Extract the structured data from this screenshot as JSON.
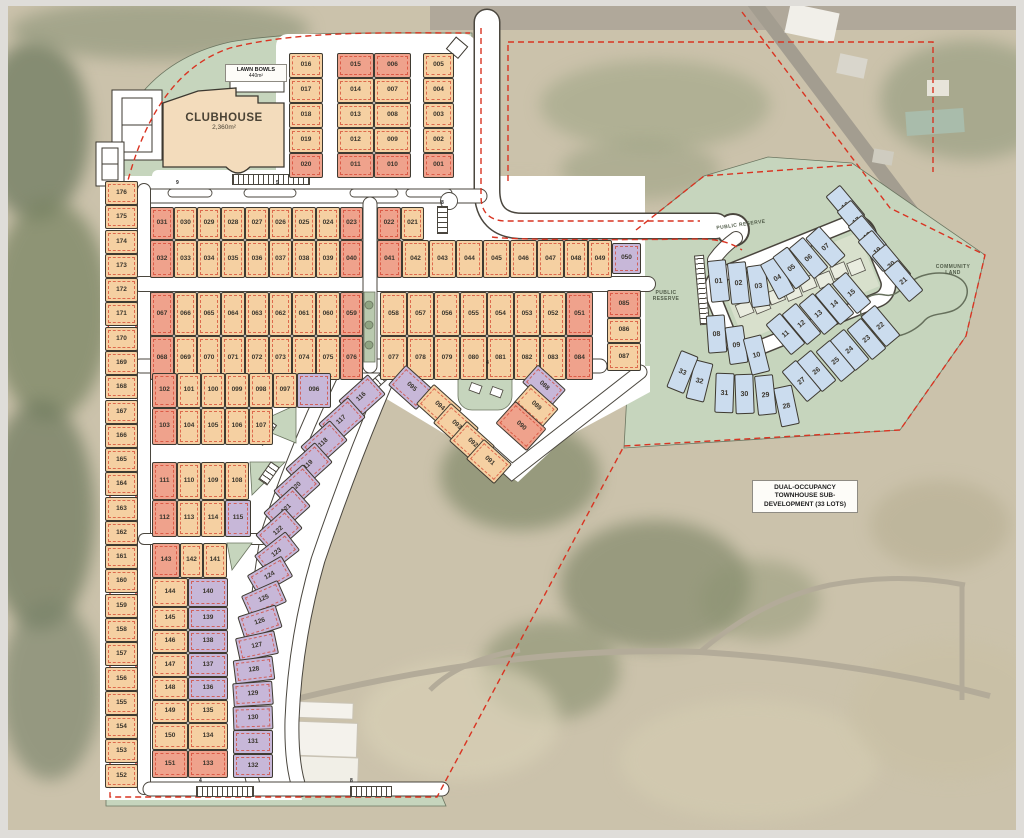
{
  "labels": {
    "clubhouse_title": "CLUBHOUSE",
    "clubhouse_area": "2,360m²",
    "lawn_bowls_title": "LAWN BOWLS",
    "lawn_bowls_area": "440m²",
    "public_reserve_a": "PUBLIC RESERVE",
    "public_reserve_b": "PUBLIC RESERVE",
    "community_land": "COMMUNITY LAND",
    "townhouse_note_line1": "DUAL-OCCUPANCY",
    "townhouse_note_line2": "TOWNHOUSE SUB-",
    "townhouse_note_line3": "DEVELOPMENT (33 LOTS)"
  },
  "palette": {
    "lot_standard": "#f5d0a2",
    "lot_premium": "#efa28c",
    "lot_medium_density": "#c7b7d8",
    "lot_townhouse": "#cbdcee",
    "reserve_green": "#c6d5bd",
    "boundary_red": "#d93422",
    "road_white": "#ffffff"
  },
  "road_markers": [
    {
      "t": "9",
      "x": 176,
      "y": 181
    },
    {
      "t": "5",
      "x": 276,
      "y": 181
    },
    {
      "t": "8",
      "x": 441,
      "y": 201
    },
    {
      "t": "4",
      "x": 199,
      "y": 779
    },
    {
      "t": "8",
      "x": 350,
      "y": 779
    },
    {
      "t": "4",
      "x": 486,
      "y": 361
    }
  ],
  "lots": [
    [
      "176",
      105,
      181,
      33,
      24,
      "p"
    ],
    [
      "175",
      105,
      205,
      33,
      24,
      "p"
    ],
    [
      "174",
      105,
      230,
      33,
      24,
      "p"
    ],
    [
      "173",
      105,
      254,
      33,
      24,
      "p"
    ],
    [
      "172",
      105,
      278,
      33,
      24,
      "p"
    ],
    [
      "171",
      105,
      302,
      33,
      24,
      "p"
    ],
    [
      "170",
      105,
      327,
      33,
      24,
      "p"
    ],
    [
      "169",
      105,
      351,
      33,
      24,
      "p"
    ],
    [
      "168",
      105,
      375,
      33,
      24,
      "p"
    ],
    [
      "167",
      105,
      400,
      33,
      24,
      "p"
    ],
    [
      "166",
      105,
      424,
      33,
      24,
      "p"
    ],
    [
      "165",
      105,
      448,
      33,
      24,
      "p"
    ],
    [
      "164",
      105,
      472,
      33,
      24,
      "p"
    ],
    [
      "163",
      105,
      497,
      33,
      24,
      "p"
    ],
    [
      "162",
      105,
      521,
      33,
      24,
      "p"
    ],
    [
      "161",
      105,
      545,
      33,
      24,
      "p"
    ],
    [
      "160",
      105,
      569,
      33,
      24,
      "p"
    ],
    [
      "159",
      105,
      594,
      33,
      24,
      "p"
    ],
    [
      "158",
      105,
      618,
      33,
      24,
      "p"
    ],
    [
      "157",
      105,
      642,
      33,
      24,
      "p"
    ],
    [
      "156",
      105,
      667,
      33,
      24,
      "p"
    ],
    [
      "155",
      105,
      691,
      33,
      24,
      "p"
    ],
    [
      "154",
      105,
      715,
      33,
      24,
      "p"
    ],
    [
      "153",
      105,
      739,
      33,
      24,
      "p"
    ],
    [
      "152",
      105,
      764,
      33,
      24,
      "p"
    ],
    [
      "016",
      289,
      53,
      34,
      25,
      "p"
    ],
    [
      "017",
      289,
      78,
      34,
      25,
      "p"
    ],
    [
      "018",
      289,
      103,
      34,
      25,
      "p"
    ],
    [
      "019",
      289,
      128,
      34,
      25,
      "p"
    ],
    [
      "020",
      289,
      153,
      34,
      25,
      "r"
    ],
    [
      "015",
      337,
      53,
      37,
      25,
      "r"
    ],
    [
      "014",
      337,
      78,
      37,
      25,
      "p"
    ],
    [
      "013",
      337,
      103,
      37,
      25,
      "p"
    ],
    [
      "012",
      337,
      128,
      37,
      25,
      "p"
    ],
    [
      "011",
      337,
      153,
      37,
      25,
      "r"
    ],
    [
      "006",
      374,
      53,
      37,
      25,
      "r"
    ],
    [
      "007",
      374,
      78,
      37,
      25,
      "p"
    ],
    [
      "008",
      374,
      103,
      37,
      25,
      "p"
    ],
    [
      "009",
      374,
      128,
      37,
      25,
      "p"
    ],
    [
      "010",
      374,
      153,
      37,
      25,
      "r"
    ],
    [
      "005",
      423,
      53,
      31,
      25,
      "p"
    ],
    [
      "004",
      423,
      78,
      31,
      25,
      "p"
    ],
    [
      "003",
      423,
      103,
      31,
      25,
      "p"
    ],
    [
      "002",
      423,
      128,
      31,
      25,
      "p"
    ],
    [
      "001",
      423,
      153,
      31,
      25,
      "r"
    ],
    [
      "031",
      150,
      207,
      24,
      33,
      "r"
    ],
    [
      "030",
      174,
      207,
      23,
      33,
      "p"
    ],
    [
      "029",
      197,
      207,
      24,
      33,
      "p"
    ],
    [
      "028",
      221,
      207,
      24,
      33,
      "p"
    ],
    [
      "027",
      245,
      207,
      24,
      33,
      "p"
    ],
    [
      "026",
      269,
      207,
      23,
      33,
      "p"
    ],
    [
      "025",
      292,
      207,
      24,
      33,
      "p"
    ],
    [
      "024",
      316,
      207,
      24,
      33,
      "p"
    ],
    [
      "023",
      340,
      207,
      23,
      33,
      "r"
    ],
    [
      "022",
      377,
      207,
      24,
      33,
      "r"
    ],
    [
      "021",
      401,
      207,
      23,
      33,
      "p"
    ],
    [
      "032",
      150,
      240,
      24,
      38,
      "r"
    ],
    [
      "033",
      174,
      240,
      23,
      38,
      "p"
    ],
    [
      "034",
      197,
      240,
      24,
      38,
      "p"
    ],
    [
      "035",
      221,
      240,
      24,
      38,
      "p"
    ],
    [
      "036",
      245,
      240,
      24,
      38,
      "p"
    ],
    [
      "037",
      269,
      240,
      23,
      38,
      "p"
    ],
    [
      "038",
      292,
      240,
      24,
      38,
      "p"
    ],
    [
      "039",
      316,
      240,
      24,
      38,
      "p"
    ],
    [
      "040",
      340,
      240,
      23,
      38,
      "r"
    ],
    [
      "041",
      377,
      240,
      25,
      38,
      "r"
    ],
    [
      "042",
      402,
      240,
      27,
      38,
      "p"
    ],
    [
      "043",
      429,
      240,
      27,
      38,
      "p"
    ],
    [
      "044",
      456,
      240,
      27,
      38,
      "p"
    ],
    [
      "045",
      483,
      240,
      27,
      38,
      "p"
    ],
    [
      "046",
      510,
      240,
      27,
      38,
      "p"
    ],
    [
      "047",
      537,
      240,
      27,
      38,
      "p"
    ],
    [
      "048",
      564,
      240,
      24,
      38,
      "p"
    ],
    [
      "049",
      588,
      240,
      24,
      38,
      "p"
    ],
    [
      "050",
      612,
      243,
      29,
      31,
      "v"
    ],
    [
      "067",
      150,
      292,
      24,
      44,
      "r"
    ],
    [
      "066",
      174,
      292,
      23,
      44,
      "p"
    ],
    [
      "065",
      197,
      292,
      24,
      44,
      "p"
    ],
    [
      "064",
      221,
      292,
      24,
      44,
      "p"
    ],
    [
      "063",
      245,
      292,
      24,
      44,
      "p"
    ],
    [
      "062",
      269,
      292,
      23,
      44,
      "p"
    ],
    [
      "061",
      292,
      292,
      24,
      44,
      "p"
    ],
    [
      "060",
      316,
      292,
      24,
      44,
      "p"
    ],
    [
      "059",
      340,
      292,
      23,
      44,
      "r"
    ],
    [
      "058",
      380,
      292,
      27,
      44,
      "p"
    ],
    [
      "057",
      407,
      292,
      27,
      44,
      "p"
    ],
    [
      "056",
      434,
      292,
      26,
      44,
      "p"
    ],
    [
      "055",
      460,
      292,
      27,
      44,
      "p"
    ],
    [
      "054",
      487,
      292,
      27,
      44,
      "p"
    ],
    [
      "053",
      514,
      292,
      26,
      44,
      "p"
    ],
    [
      "052",
      540,
      292,
      26,
      44,
      "p"
    ],
    [
      "051",
      566,
      292,
      27,
      44,
      "r"
    ],
    [
      "068",
      150,
      336,
      24,
      44,
      "r"
    ],
    [
      "069",
      174,
      336,
      23,
      44,
      "p"
    ],
    [
      "070",
      197,
      336,
      24,
      44,
      "p"
    ],
    [
      "071",
      221,
      336,
      24,
      44,
      "p"
    ],
    [
      "072",
      245,
      336,
      24,
      44,
      "p"
    ],
    [
      "073",
      269,
      336,
      23,
      44,
      "p"
    ],
    [
      "074",
      292,
      336,
      24,
      44,
      "p"
    ],
    [
      "075",
      316,
      336,
      24,
      44,
      "p"
    ],
    [
      "076",
      340,
      336,
      23,
      44,
      "r"
    ],
    [
      "077",
      380,
      336,
      27,
      44,
      "p"
    ],
    [
      "078",
      407,
      336,
      27,
      44,
      "p"
    ],
    [
      "079",
      434,
      336,
      26,
      44,
      "p"
    ],
    [
      "080",
      460,
      336,
      27,
      44,
      "p"
    ],
    [
      "081",
      487,
      336,
      27,
      44,
      "p"
    ],
    [
      "082",
      514,
      336,
      26,
      44,
      "p"
    ],
    [
      "083",
      540,
      336,
      26,
      44,
      "p"
    ],
    [
      "084",
      566,
      336,
      27,
      44,
      "r"
    ],
    [
      "085",
      607,
      290,
      34,
      28,
      "r"
    ],
    [
      "086",
      607,
      318,
      34,
      25,
      "p"
    ],
    [
      "087",
      607,
      343,
      34,
      28,
      "p"
    ],
    [
      "102",
      152,
      373,
      25,
      35,
      "r"
    ],
    [
      "101",
      177,
      373,
      24,
      35,
      "p"
    ],
    [
      "100",
      201,
      373,
      24,
      35,
      "p"
    ],
    [
      "099",
      225,
      373,
      24,
      35,
      "p"
    ],
    [
      "098",
      249,
      373,
      24,
      35,
      "p"
    ],
    [
      "097",
      273,
      373,
      24,
      35,
      "p"
    ],
    [
      "096",
      297,
      373,
      34,
      35,
      "v"
    ],
    [
      "103",
      152,
      408,
      25,
      37,
      "r"
    ],
    [
      "104",
      177,
      408,
      24,
      37,
      "p"
    ],
    [
      "105",
      201,
      408,
      24,
      37,
      "p"
    ],
    [
      "106",
      225,
      408,
      24,
      37,
      "p"
    ],
    [
      "107",
      249,
      408,
      24,
      37,
      "p"
    ],
    [
      "111",
      152,
      462,
      25,
      38,
      "r"
    ],
    [
      "110",
      177,
      462,
      24,
      38,
      "p"
    ],
    [
      "109",
      201,
      462,
      24,
      38,
      "p"
    ],
    [
      "108",
      225,
      462,
      24,
      38,
      "p"
    ],
    [
      "112",
      152,
      500,
      25,
      37,
      "r"
    ],
    [
      "113",
      177,
      500,
      24,
      37,
      "p"
    ],
    [
      "114",
      201,
      500,
      24,
      37,
      "p"
    ],
    [
      "115",
      225,
      500,
      26,
      37,
      "v"
    ],
    [
      "143",
      152,
      543,
      28,
      35,
      "r"
    ],
    [
      "142",
      180,
      543,
      23,
      35,
      "p"
    ],
    [
      "141",
      203,
      543,
      24,
      35,
      "p"
    ],
    [
      "144",
      152,
      578,
      36,
      29,
      "p"
    ],
    [
      "140",
      188,
      578,
      40,
      29,
      "v"
    ],
    [
      "145",
      152,
      607,
      36,
      23,
      "p"
    ],
    [
      "139",
      188,
      607,
      40,
      23,
      "v"
    ],
    [
      "146",
      152,
      630,
      36,
      23,
      "p"
    ],
    [
      "138",
      188,
      630,
      40,
      23,
      "v"
    ],
    [
      "147",
      152,
      653,
      36,
      24,
      "p"
    ],
    [
      "137",
      188,
      653,
      40,
      24,
      "v"
    ],
    [
      "148",
      152,
      677,
      36,
      23,
      "p"
    ],
    [
      "136",
      188,
      677,
      40,
      23,
      "v"
    ],
    [
      "149",
      152,
      700,
      36,
      23,
      "p"
    ],
    [
      "135",
      188,
      700,
      40,
      23,
      "p"
    ],
    [
      "150",
      152,
      723,
      36,
      27,
      "p"
    ],
    [
      "134",
      188,
      723,
      40,
      27,
      "p"
    ],
    [
      "151",
      152,
      750,
      36,
      28,
      "r"
    ],
    [
      "133",
      188,
      750,
      40,
      28,
      "r"
    ],
    [
      "116",
      342,
      384,
      40,
      27,
      "v",
      -42
    ],
    [
      "117",
      322,
      407,
      40,
      27,
      "v",
      -42
    ],
    [
      "118",
      304,
      430,
      40,
      27,
      "v",
      -42
    ],
    [
      "119",
      289,
      452,
      40,
      27,
      "v",
      -42
    ],
    [
      "120",
      277,
      474,
      40,
      27,
      "v",
      -42
    ],
    [
      "121",
      267,
      496,
      40,
      27,
      "v",
      -42
    ],
    [
      "122",
      259,
      518,
      40,
      27,
      "v",
      -42
    ],
    [
      "123",
      257,
      541,
      40,
      24,
      "v",
      -38
    ],
    [
      "124",
      250,
      564,
      40,
      24,
      "v",
      -30
    ],
    [
      "125",
      244,
      587,
      40,
      24,
      "v",
      -24
    ],
    [
      "126",
      240,
      610,
      40,
      24,
      "v",
      -18
    ],
    [
      "127",
      237,
      634,
      40,
      24,
      "v",
      -12
    ],
    [
      "128",
      234,
      658,
      40,
      24,
      "v",
      -7
    ],
    [
      "129",
      233,
      682,
      40,
      24,
      "v",
      -4
    ],
    [
      "130",
      233,
      706,
      40,
      24,
      "v",
      -2
    ],
    [
      "131",
      233,
      730,
      40,
      24,
      "v",
      0
    ],
    [
      "132",
      233,
      754,
      40,
      24,
      "v",
      0
    ],
    [
      "095",
      392,
      374,
      38,
      27,
      "v",
      42
    ],
    [
      "094",
      420,
      393,
      38,
      27,
      "p",
      42
    ],
    [
      "093",
      437,
      412,
      38,
      27,
      "p",
      42
    ],
    [
      "092",
      453,
      430,
      38,
      27,
      "p",
      42
    ],
    [
      "091",
      470,
      448,
      38,
      27,
      "p",
      42
    ],
    [
      "088",
      525,
      374,
      38,
      24,
      "v",
      42
    ],
    [
      "089",
      517,
      393,
      38,
      26,
      "p",
      42
    ],
    [
      "090",
      500,
      411,
      42,
      30,
      "r",
      42
    ]
  ],
  "townhouse_lots": [
    [
      "01",
      709,
      260,
      19,
      42,
      "b",
      -6
    ],
    [
      "02",
      729,
      262,
      19,
      42,
      "b",
      -6
    ],
    [
      "03",
      749,
      265,
      19,
      42,
      "b",
      -8
    ],
    [
      "04",
      768,
      258,
      19,
      40,
      "b",
      -28
    ],
    [
      "05",
      782,
      248,
      19,
      40,
      "b",
      -36
    ],
    [
      "06",
      799,
      238,
      19,
      40,
      "b",
      -40
    ],
    [
      "07",
      816,
      227,
      19,
      40,
      "b",
      -42
    ],
    [
      "08",
      707,
      315,
      19,
      38,
      "b",
      -4
    ],
    [
      "09",
      727,
      326,
      19,
      38,
      "b",
      -8
    ],
    [
      "10",
      747,
      336,
      19,
      38,
      "b",
      -14
    ],
    [
      "11",
      776,
      314,
      19,
      40,
      "b",
      -40
    ],
    [
      "12",
      792,
      304,
      19,
      40,
      "b",
      -40
    ],
    [
      "13",
      809,
      294,
      19,
      40,
      "b",
      -40
    ],
    [
      "14",
      825,
      284,
      19,
      40,
      "b",
      -40
    ],
    [
      "15",
      842,
      273,
      19,
      40,
      "b",
      -40
    ],
    [
      "16",
      836,
      186,
      19,
      40,
      "b",
      -40
    ],
    [
      "17",
      847,
      201,
      19,
      40,
      "b",
      -40
    ],
    [
      "18",
      858,
      216,
      19,
      40,
      "b",
      -40
    ],
    [
      "19",
      868,
      231,
      19,
      40,
      "b",
      -40
    ],
    [
      "20",
      882,
      245,
      19,
      40,
      "b",
      -40
    ],
    [
      "21",
      894,
      261,
      19,
      40,
      "b",
      -40
    ],
    [
      "22",
      871,
      306,
      19,
      40,
      "b",
      -40
    ],
    [
      "23",
      857,
      319,
      19,
      40,
      "b",
      -40
    ],
    [
      "24",
      840,
      330,
      19,
      40,
      "b",
      -40
    ],
    [
      "25",
      826,
      341,
      19,
      40,
      "b",
      -40
    ],
    [
      "26",
      807,
      351,
      19,
      40,
      "b",
      -40
    ],
    [
      "27",
      792,
      361,
      19,
      40,
      "b",
      -40
    ],
    [
      "28",
      777,
      386,
      19,
      40,
      "b",
      -12
    ],
    [
      "29",
      756,
      375,
      19,
      40,
      "b",
      -6
    ],
    [
      "30",
      735,
      374,
      19,
      40,
      "b",
      -2
    ],
    [
      "31",
      715,
      373,
      19,
      40,
      "b",
      2
    ],
    [
      "32",
      690,
      361,
      19,
      40,
      "b",
      14
    ],
    [
      "33",
      673,
      352,
      19,
      40,
      "b",
      22
    ]
  ]
}
